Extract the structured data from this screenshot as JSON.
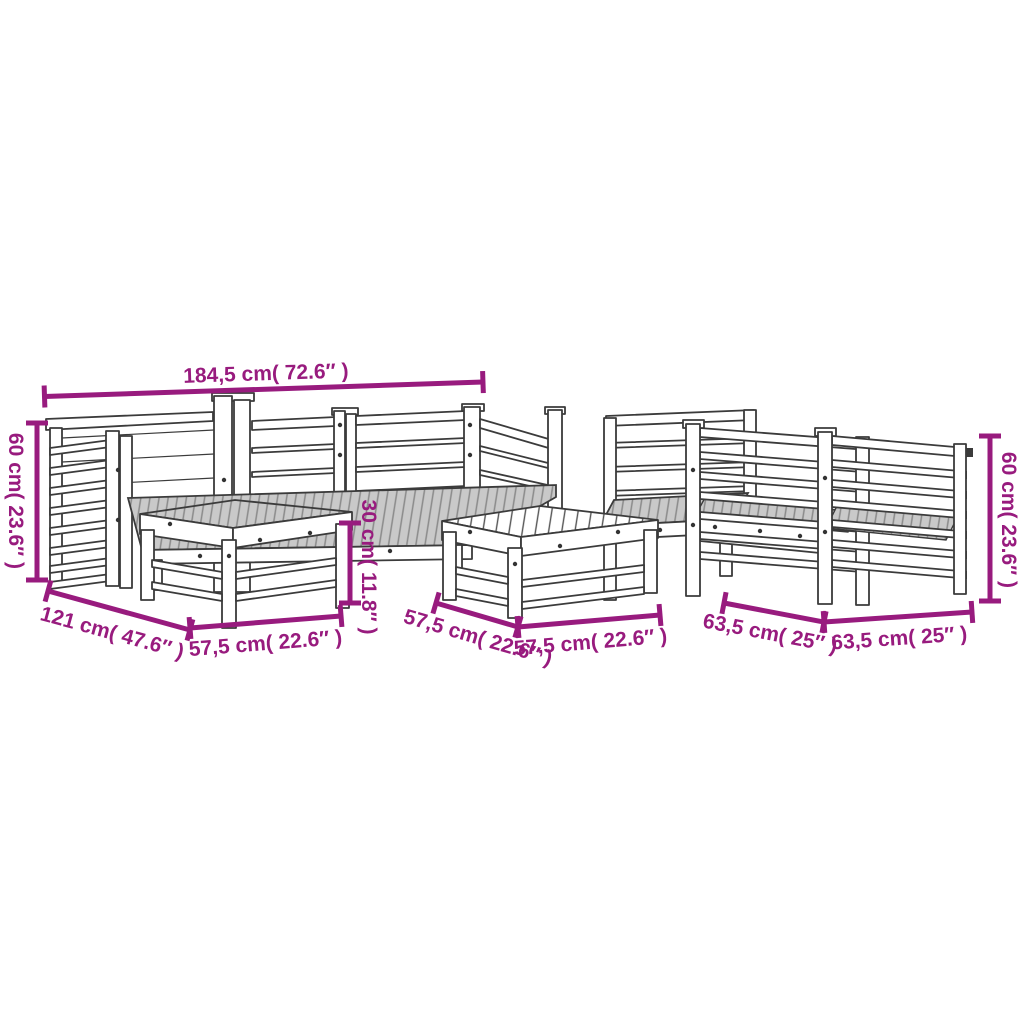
{
  "diagram": {
    "type": "product-dimension-diagram",
    "subject": "garden lounge furniture set line drawing",
    "background": "#ffffff"
  },
  "colors": {
    "dimension_accent": "#981B7E",
    "line_art": "#3b3b3b",
    "seat_shading": "#c9c9c9"
  },
  "dimensions": [
    {
      "id": "sofa-total-width",
      "label": "184,5 cm( 72.6″ )"
    },
    {
      "id": "sofa-height-left",
      "label": "60 cm( 23.6″ )"
    },
    {
      "id": "sofa-depth",
      "label": "121 cm( 47.6″ )"
    },
    {
      "id": "table-1-width",
      "label": "57,5 cm( 22.6″ )"
    },
    {
      "id": "table-height",
      "label": "30 cm( 11.8″ )"
    },
    {
      "id": "table-2-depth",
      "label": "57,5 cm( 22.6″ )"
    },
    {
      "id": "table-2-width",
      "label": "57,5 cm( 22.6″ )"
    },
    {
      "id": "chair-depth",
      "label": "63,5 cm( 25″ )"
    },
    {
      "id": "chair-width",
      "label": "63,5 cm( 25″ )"
    },
    {
      "id": "chair-height-right",
      "label": "60 cm( 23.6″ )"
    }
  ]
}
